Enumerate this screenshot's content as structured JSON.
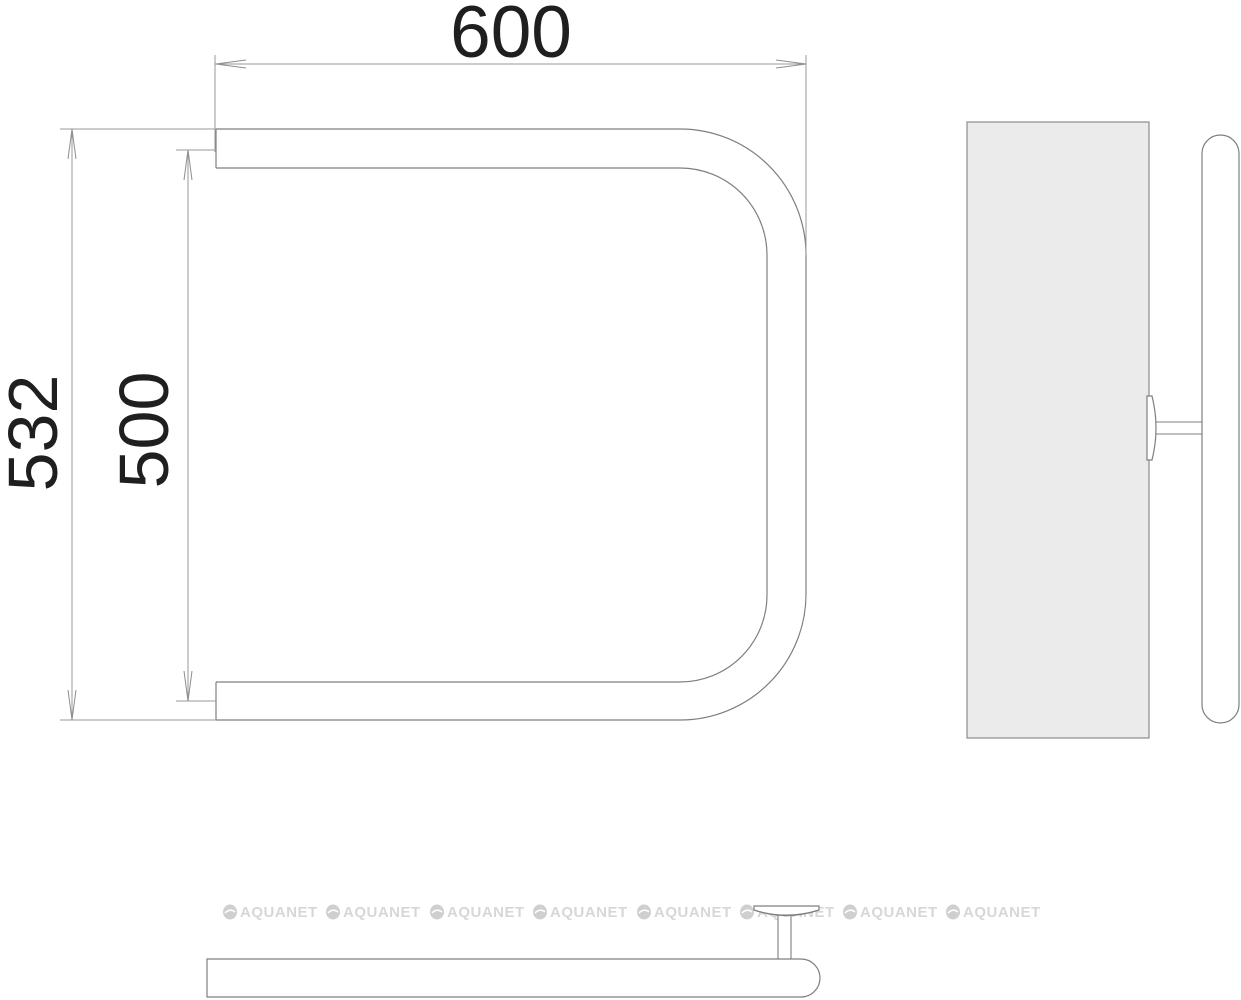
{
  "page": {
    "background": "#ffffff"
  },
  "drawing": {
    "type": "technical-drawing-towel-rail",
    "dimensions": {
      "width_top": "600",
      "height_overall": "532",
      "height_axis": "500"
    },
    "watermark": {
      "text": "AQUANET",
      "count": 8,
      "color": "#d7d7d7"
    },
    "colors": {
      "outline": "#7f7f7f",
      "dimension_line": "#9a9a9a",
      "dimension_text": "#1f1f1f",
      "panel_fill": "#ebebeb",
      "background": "#ffffff"
    }
  }
}
